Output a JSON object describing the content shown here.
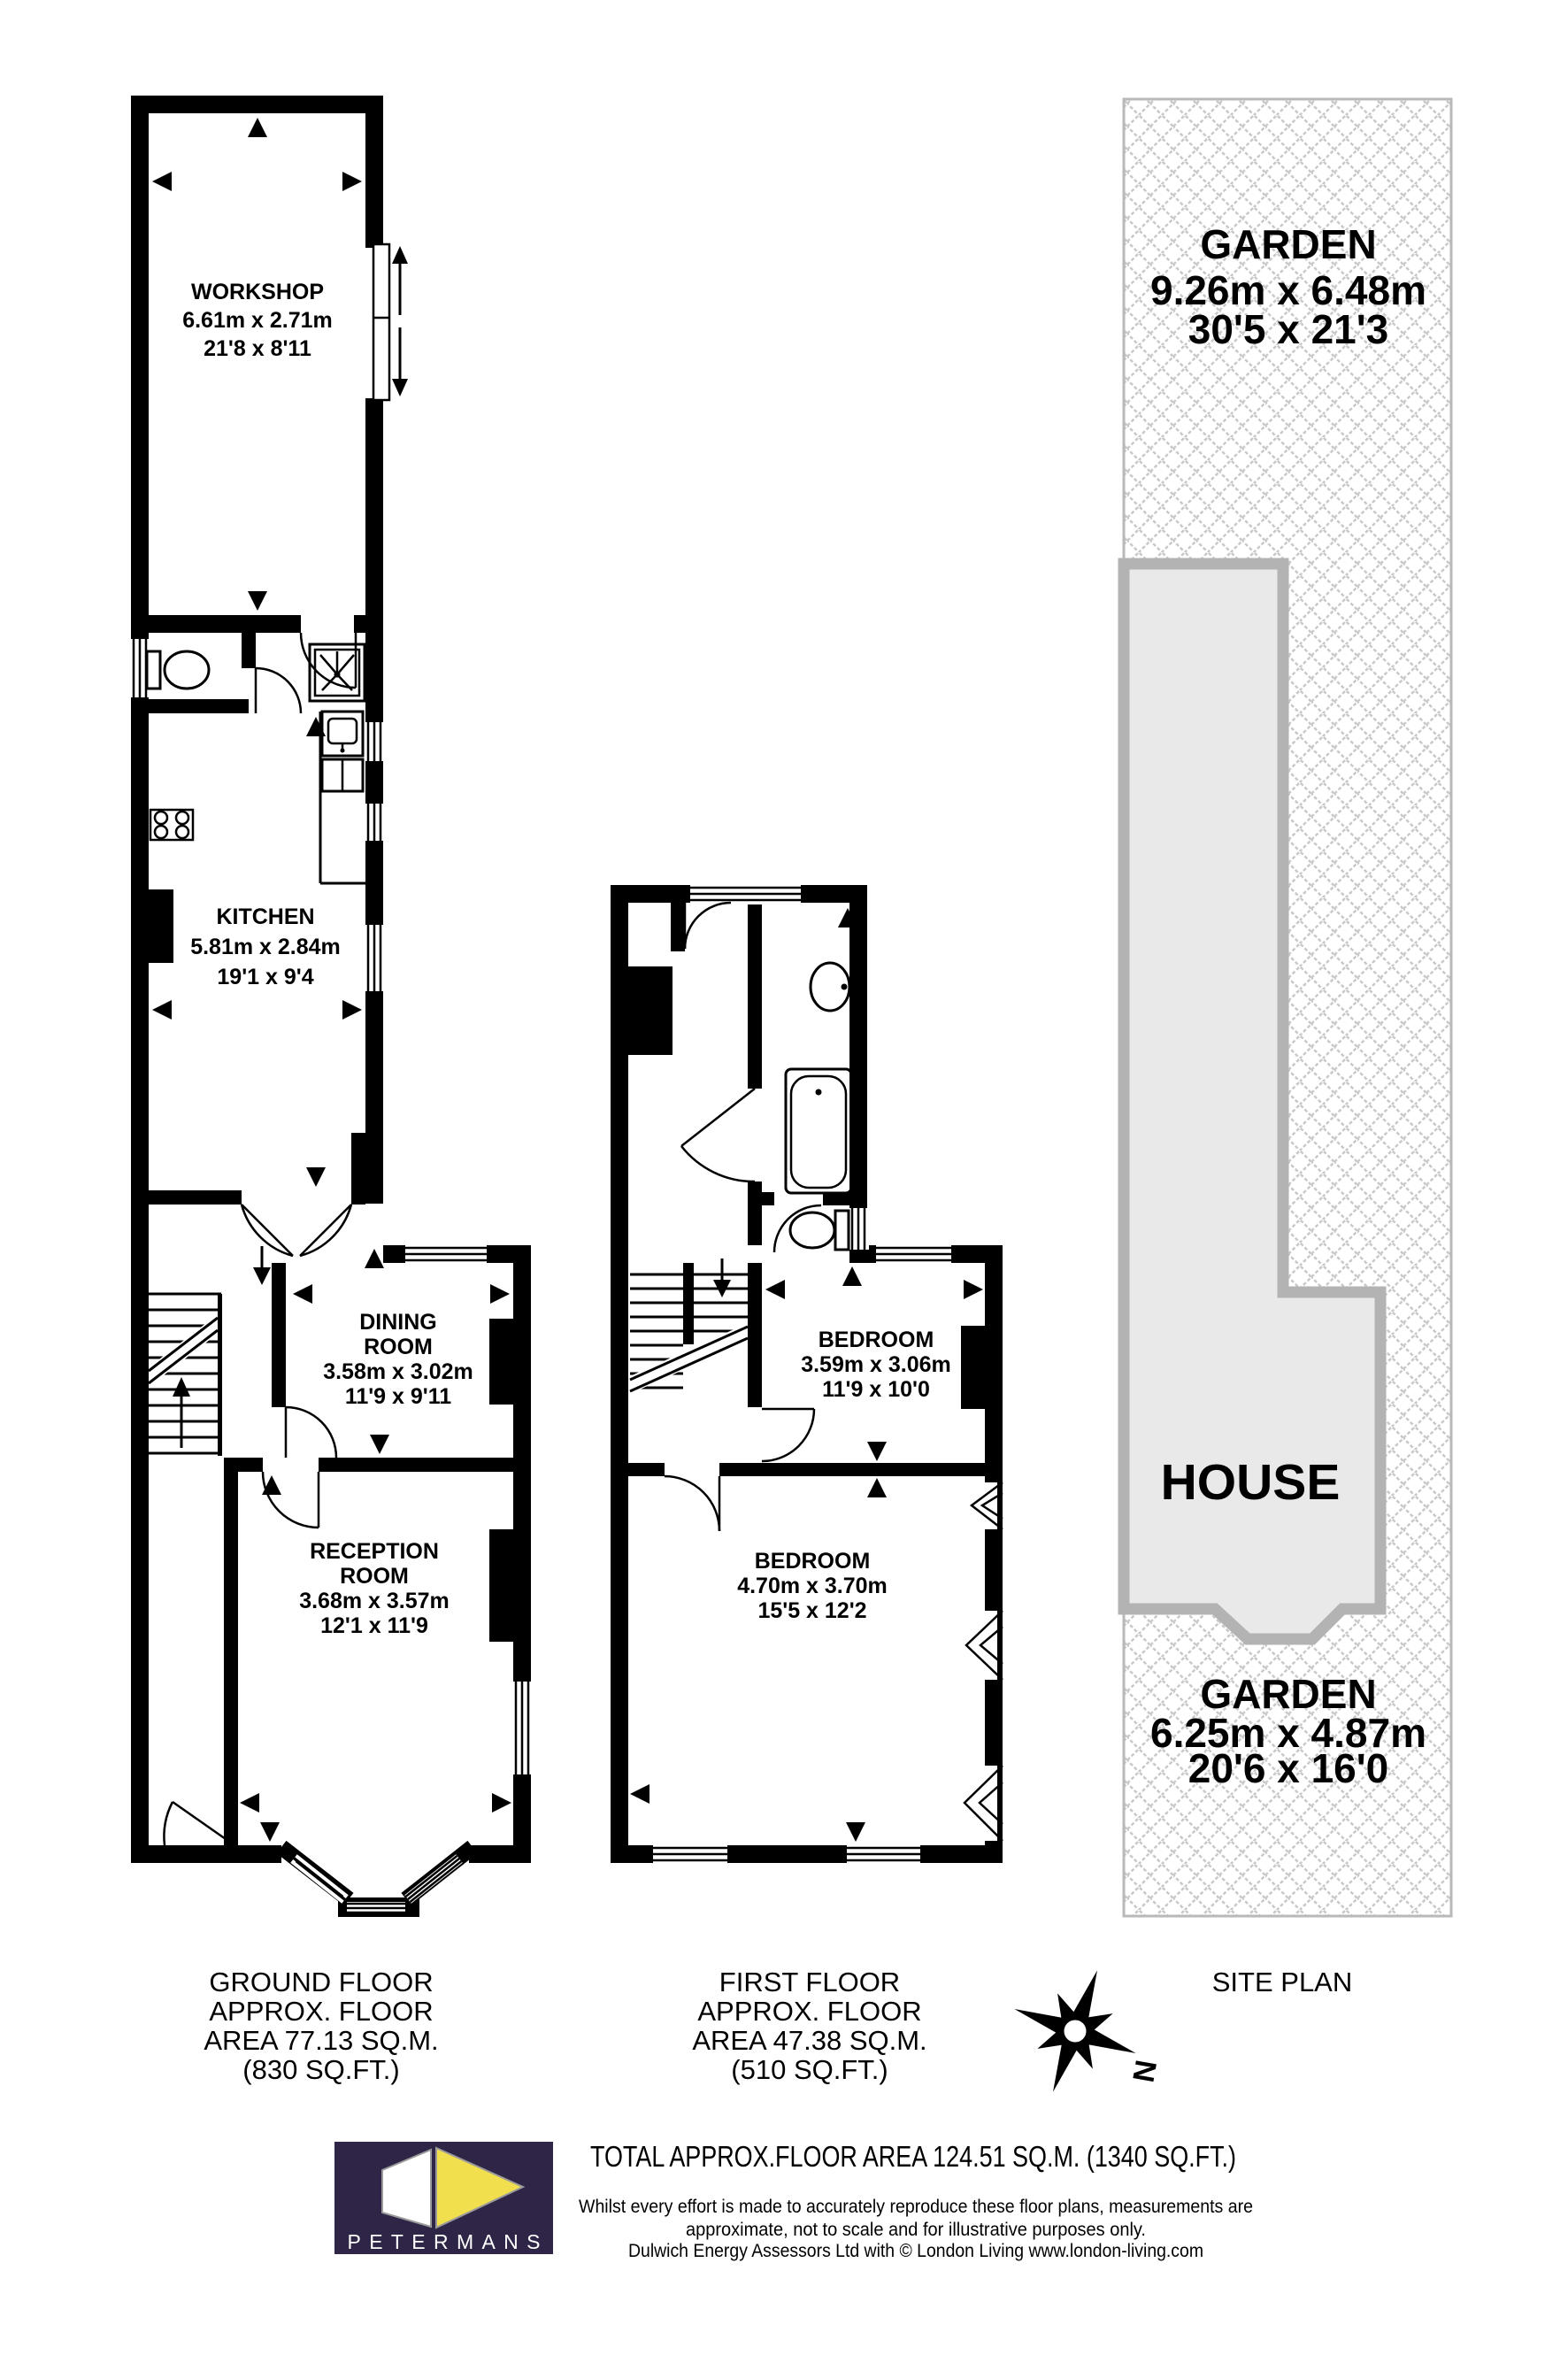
{
  "ground_floor": {
    "caption_lines": [
      "GROUND FLOOR",
      "APPROX. FLOOR",
      "AREA 77.13 SQ.M.",
      "(830 SQ.FT.)"
    ],
    "workshop": {
      "name": "WORKSHOP",
      "metric": "6.61m x 2.71m",
      "imperial": "21'8 x 8'11"
    },
    "kitchen": {
      "name": "KITCHEN",
      "metric": "5.81m x 2.84m",
      "imperial": "19'1 x 9'4"
    },
    "dining_room": {
      "name_line1": "DINING",
      "name_line2": "ROOM",
      "metric": "3.58m x 3.02m",
      "imperial": "11'9 x 9'11"
    },
    "reception_room": {
      "name_line1": "RECEPTION",
      "name_line2": "ROOM",
      "metric": "3.68m x 3.57m",
      "imperial": "12'1 x 11'9"
    }
  },
  "first_floor": {
    "caption_lines": [
      "FIRST FLOOR",
      "APPROX. FLOOR",
      "AREA 47.38 SQ.M.",
      "(510 SQ.FT.)"
    ],
    "bedroom_rear": {
      "name": "BEDROOM",
      "metric": "3.59m x 3.06m",
      "imperial": "11'9 x 10'0"
    },
    "bedroom_front": {
      "name": "BEDROOM",
      "metric": "4.70m x 3.70m",
      "imperial": "15'5 x 12'2"
    }
  },
  "site_plan": {
    "caption": "SITE PLAN",
    "garden_rear": {
      "name": "GARDEN",
      "metric": "9.26m x 6.48m",
      "imperial": "30'5 x 21'3"
    },
    "house": {
      "name": "HOUSE"
    },
    "garden_front": {
      "name": "GARDEN",
      "metric": "6.25m x 4.87m",
      "imperial": "20'6 x 16'0"
    }
  },
  "compass": {
    "north": "N"
  },
  "footer": {
    "brand": "PETERMANS",
    "total_area": "TOTAL APPROX.FLOOR AREA 124.51 SQ.M. (1340 SQ.FT.)",
    "disclaimer_line1": "Whilst every effort is made to accurately reproduce these floor plans, measurements are",
    "disclaimer_line2": "approximate, not to scale and for illustrative purposes only.",
    "disclaimer_line3": "Dulwich Energy Assessors Ltd with © London Living www.london-living.com"
  },
  "colors": {
    "wall": "#000000",
    "house_fill": "#e9e9e9",
    "house_border": "#b3b3b3",
    "hatch": "#c9c9c9",
    "logo_bg": "#2e2547",
    "logo_yellow": "#f2df4e"
  }
}
